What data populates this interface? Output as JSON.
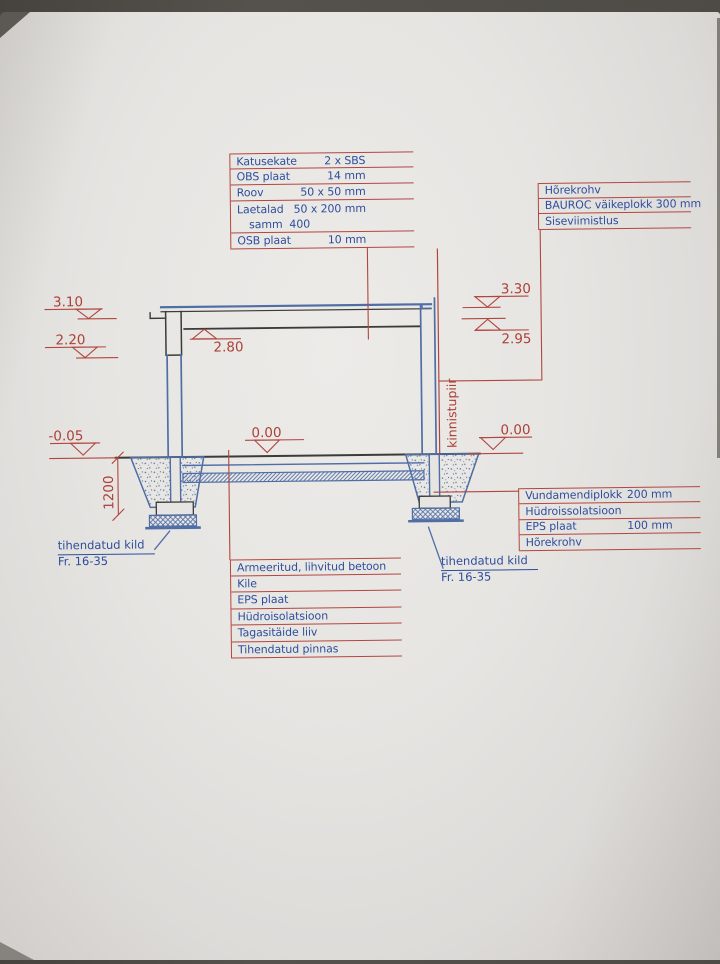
{
  "blocks": {
    "roof": {
      "rows": [
        {
          "label": "Katusekate",
          "value": "2 x SBS"
        },
        {
          "label": "OBS plaat",
          "value": "14 mm"
        },
        {
          "label": "Roov",
          "value": "50 x 50 mm"
        },
        {
          "label": "Laetalad",
          "value": "50 x 200 mm"
        },
        {
          "label": "samm  400",
          "value": ""
        },
        {
          "label": "OSB plaat",
          "value": "10 mm"
        }
      ]
    },
    "wall": {
      "rows": [
        "Hõrekrohv",
        "BAUROC väikeplokk 300 mm",
        "Siseviimistlus"
      ]
    },
    "foundation": {
      "rows": [
        {
          "label": "Vundamendiplokk",
          "value": "200 mm"
        },
        {
          "label": "Hüdroissolatsioon",
          "value": ""
        },
        {
          "label": "EPS plaat",
          "value": "100 mm"
        },
        {
          "label": "Hõrekrohv",
          "value": ""
        }
      ]
    },
    "floor": {
      "rows": [
        "Armeeritud, lihvitud betoon",
        "Kile",
        "EPS plaat",
        "Hüdroisolatsioon",
        "Tagasitäide liiv",
        "Tihendatud pinnas"
      ]
    }
  },
  "gravel_left": {
    "line1": "tihendatud kild",
    "line2": "Fr. 16-35"
  },
  "gravel_right": {
    "line1": "tihendatud kild",
    "line2": "Fr. 16-35"
  },
  "levels": {
    "roof_left": "3.10",
    "eave_left": "2.20",
    "roof_right": "3.30",
    "wall_right": "2.95",
    "ceiling": "2.80",
    "ground_left": "-0.05",
    "floor_left": "0.00",
    "ground_right": "0.00"
  },
  "dimensions": {
    "foundation_depth": "1200"
  },
  "boundary_label": "kinnistupiir",
  "colors": {
    "annotation_red": "#b2463f",
    "text_blue": "#2d4e9d",
    "drawing_blue": "#4f6ea6",
    "drawing_black": "#3b3b39",
    "paper": "#e7e5e2"
  }
}
